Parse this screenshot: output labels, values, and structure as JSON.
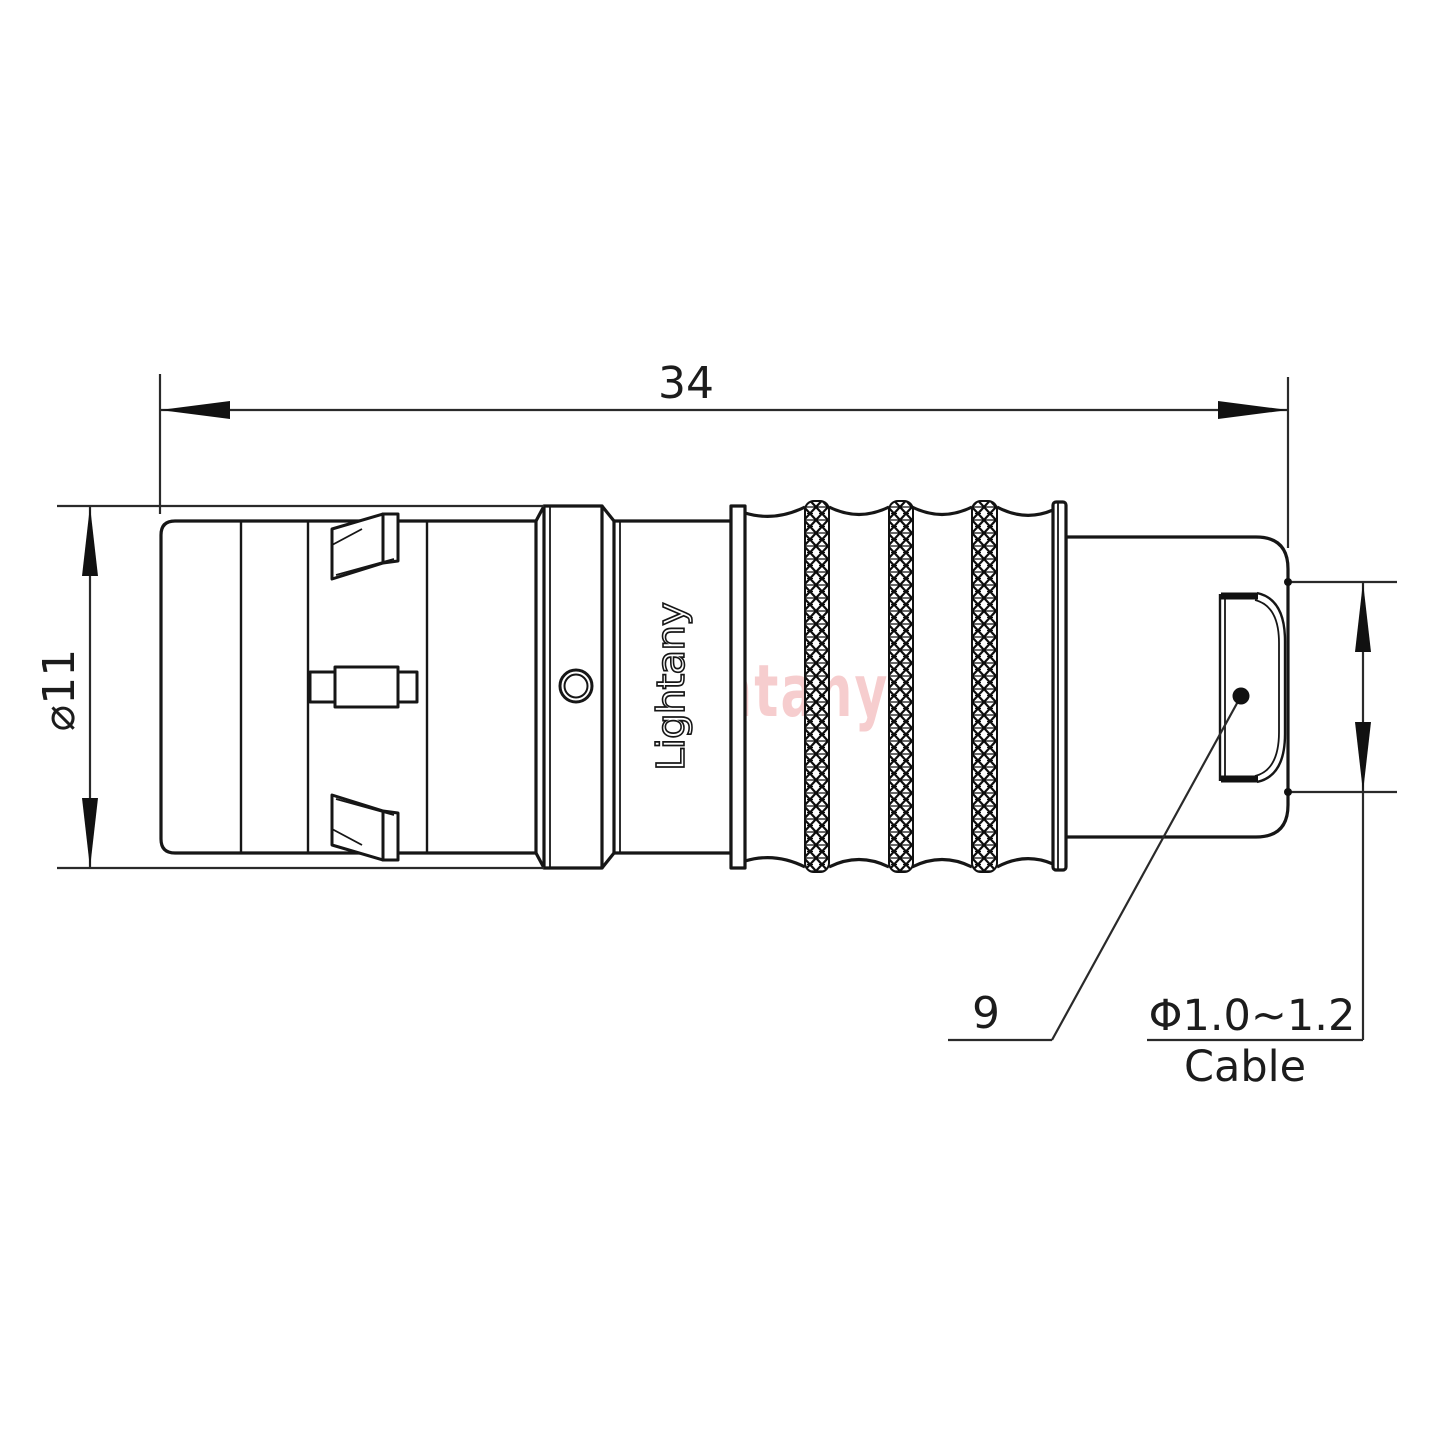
{
  "drawing": {
    "type": "connector-technical-drawing",
    "dimensions": {
      "overall_length": "34",
      "body_diameter": "⌀11",
      "rear_section_length": "9",
      "cable_diameter_range": "Φ1.0~1.2",
      "cable_label": "Cable"
    },
    "branding": {
      "engraved_logo": "Lightany",
      "watermark_logo": "Lightany"
    },
    "colors": {
      "line": "#1c1c1c",
      "watermark_pink": "#e9898b",
      "background": "#ffffff"
    }
  }
}
